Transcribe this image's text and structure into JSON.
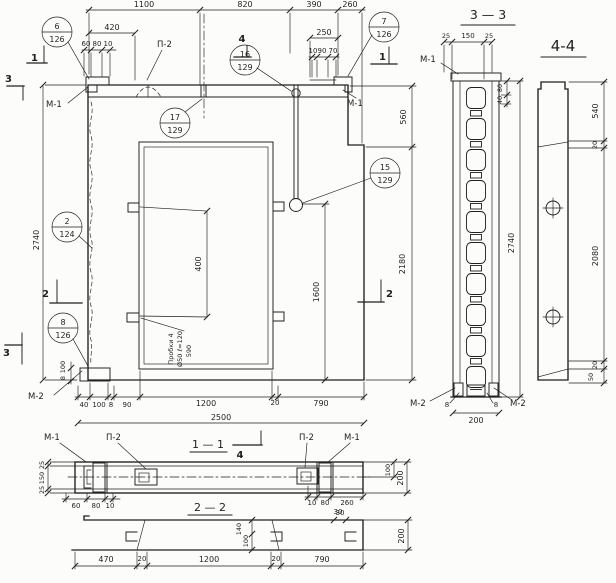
{
  "colors": {
    "bg": "#fcfcfa",
    "ink": "#1f1f1f"
  },
  "titles": {
    "s33": "3 — 3",
    "s44": "4-4",
    "s11": "1 — 1",
    "s22": "2 — 2"
  },
  "marks": {
    "m1": "М-1",
    "m2": "М-2",
    "p2": "П-2"
  },
  "cuts": {
    "c1": "1",
    "c2": "2",
    "c3": "3",
    "c4": "4"
  },
  "callouts": {
    "b6": {
      "num": "6",
      "sheet": "126"
    },
    "b7": {
      "num": "7",
      "sheet": "126"
    },
    "b16": {
      "num": "16",
      "sheet": "129"
    },
    "b17": {
      "num": "17",
      "sheet": "129"
    },
    "b15": {
      "num": "15",
      "sheet": "129"
    },
    "b2": {
      "num": "2",
      "sheet": "124"
    },
    "b8": {
      "num": "8",
      "sheet": "126"
    }
  },
  "note": {
    "l1": "Пробки 4",
    "l2": "Ø50 ℓ=120",
    "l3": "590"
  },
  "dims": {
    "d8": "8",
    "d10": "10",
    "d20": "20",
    "d25": "25",
    "d30": "30",
    "d40": "40",
    "d50": "50",
    "d60": "60",
    "d70": "70",
    "d80": "80",
    "d90": "90",
    "d100": "100",
    "d140": "140",
    "d150": "150",
    "d200": "200",
    "d250": "250",
    "d260": "260",
    "d390": "390",
    "d400": "400",
    "d420": "420",
    "d470": "470",
    "d540": "540",
    "d560": "560",
    "d790": "790",
    "d820": "820",
    "d1100": "1100",
    "d1200": "1200",
    "d1600": "1600",
    "d2080": "2080",
    "d2180": "2180",
    "d2500": "2500",
    "d2740": "2740"
  }
}
